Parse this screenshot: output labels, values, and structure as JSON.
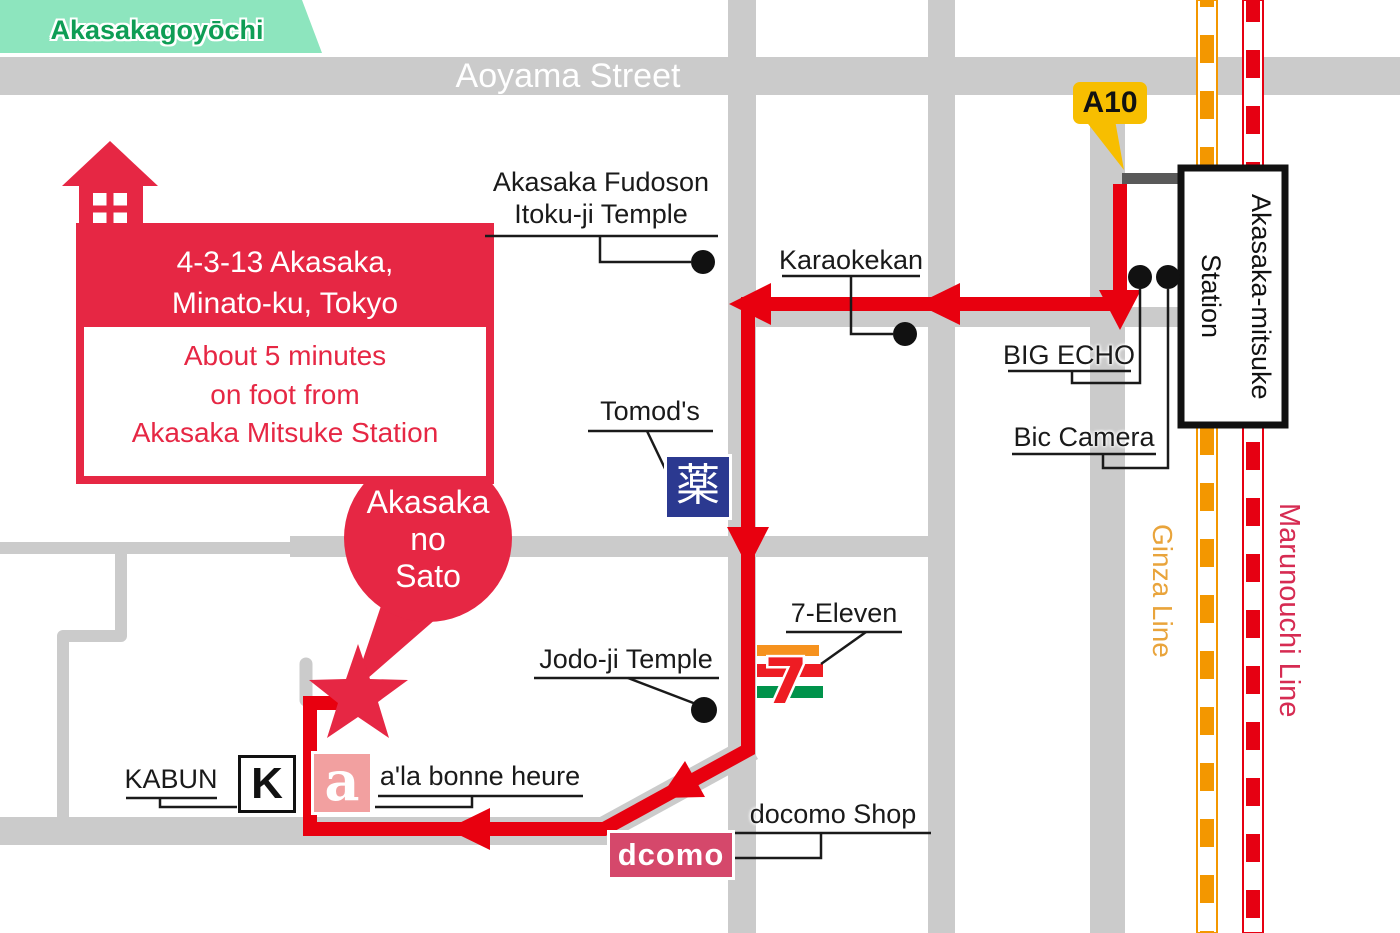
{
  "colors": {
    "road": "#CBCBCB",
    "route_red": "#E8000F",
    "landmark_red": "#E62744",
    "green_area": "#8DE5BE",
    "green_text": "#0E9D55",
    "ginza_orange": "#F39700",
    "ginza_label": "#E9A43B",
    "marunouchi_red": "#E60012",
    "marunouchi_label": "#D62B52",
    "a10_yellow": "#F7BE00",
    "pharmacy_blue": "#2B3990",
    "docomo_pink": "#D5486B",
    "a_box_pink": "#F2A0A0",
    "seven_orange": "#F6921E",
    "seven_red": "#EE1C23",
    "seven_green": "#00934B"
  },
  "region": {
    "label": "Akasakagoyōchi"
  },
  "streets": {
    "aoyama": "Aoyama Street"
  },
  "railways": {
    "ginza": "Ginza Line",
    "marunouchi": "Marunouchi Line"
  },
  "station": {
    "name": "Akasaka-mitsuke\nStation",
    "exit_label": "A10"
  },
  "destination": {
    "balloon": "Akasaka\nno\nSato",
    "address": "4-3-13 Akasaka,\nMinato-ku, Tokyo",
    "walk_note": "About 5 minutes\non foot from\nAkasaka Mitsuke Station"
  },
  "landmarks": {
    "fudoson": "Akasaka Fudoson\nItoku-ji Temple",
    "karaokekan": "Karaokekan",
    "big_echo": "BIG ECHO",
    "bic_camera": "Bic Camera",
    "tomods": "Tomod's",
    "seven_eleven": "7-Eleven",
    "jodoji": "Jodo-ji Temple",
    "kabun": "KABUN",
    "a_la_bonne_heure": "a'la bonne heure",
    "docomo_shop": "docomo Shop"
  },
  "icons": {
    "pharmacy_kanji": "薬",
    "seven_glyph": "7",
    "kabun_initial": "K",
    "a_initial": "a",
    "docomo_logo": "dcomo"
  }
}
